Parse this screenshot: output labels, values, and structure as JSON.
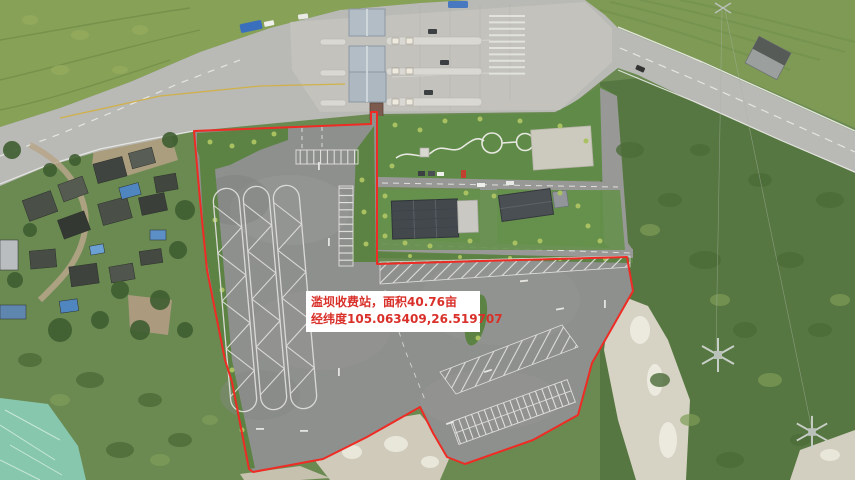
{
  "annotation": {
    "line1": "滥坝收费站，面积40.76亩",
    "line2": "经纬度105.063409,26.519707",
    "text_color": "#d9302a",
    "box_background": "#ffffff"
  },
  "site": {
    "name": "滥坝收费站",
    "area_mu": "40.76",
    "longitude": "105.063409",
    "latitude": "26.519707"
  },
  "boundary": {
    "color": "#ee2b24",
    "points": "194,131 371,124 371,112 377,112 377,264 627,257 633,291 612,328 592,363 578,415 533,440 465,464 447,457 433,433 420,407 367,437 323,459 253,472 249,469 232,382 225,360 207,270 200,200"
  },
  "palette": {
    "vegetation_base": "#6b8a52",
    "hillside": "#87a156",
    "asphalt_lot": "#8e908e",
    "highway": "#b9b9b5",
    "toll_canopy": "#b3bdc6",
    "quarry_rock": "#d6d2c4",
    "tarp": "#86c7ae",
    "boundary_red": "#ee2b24"
  }
}
